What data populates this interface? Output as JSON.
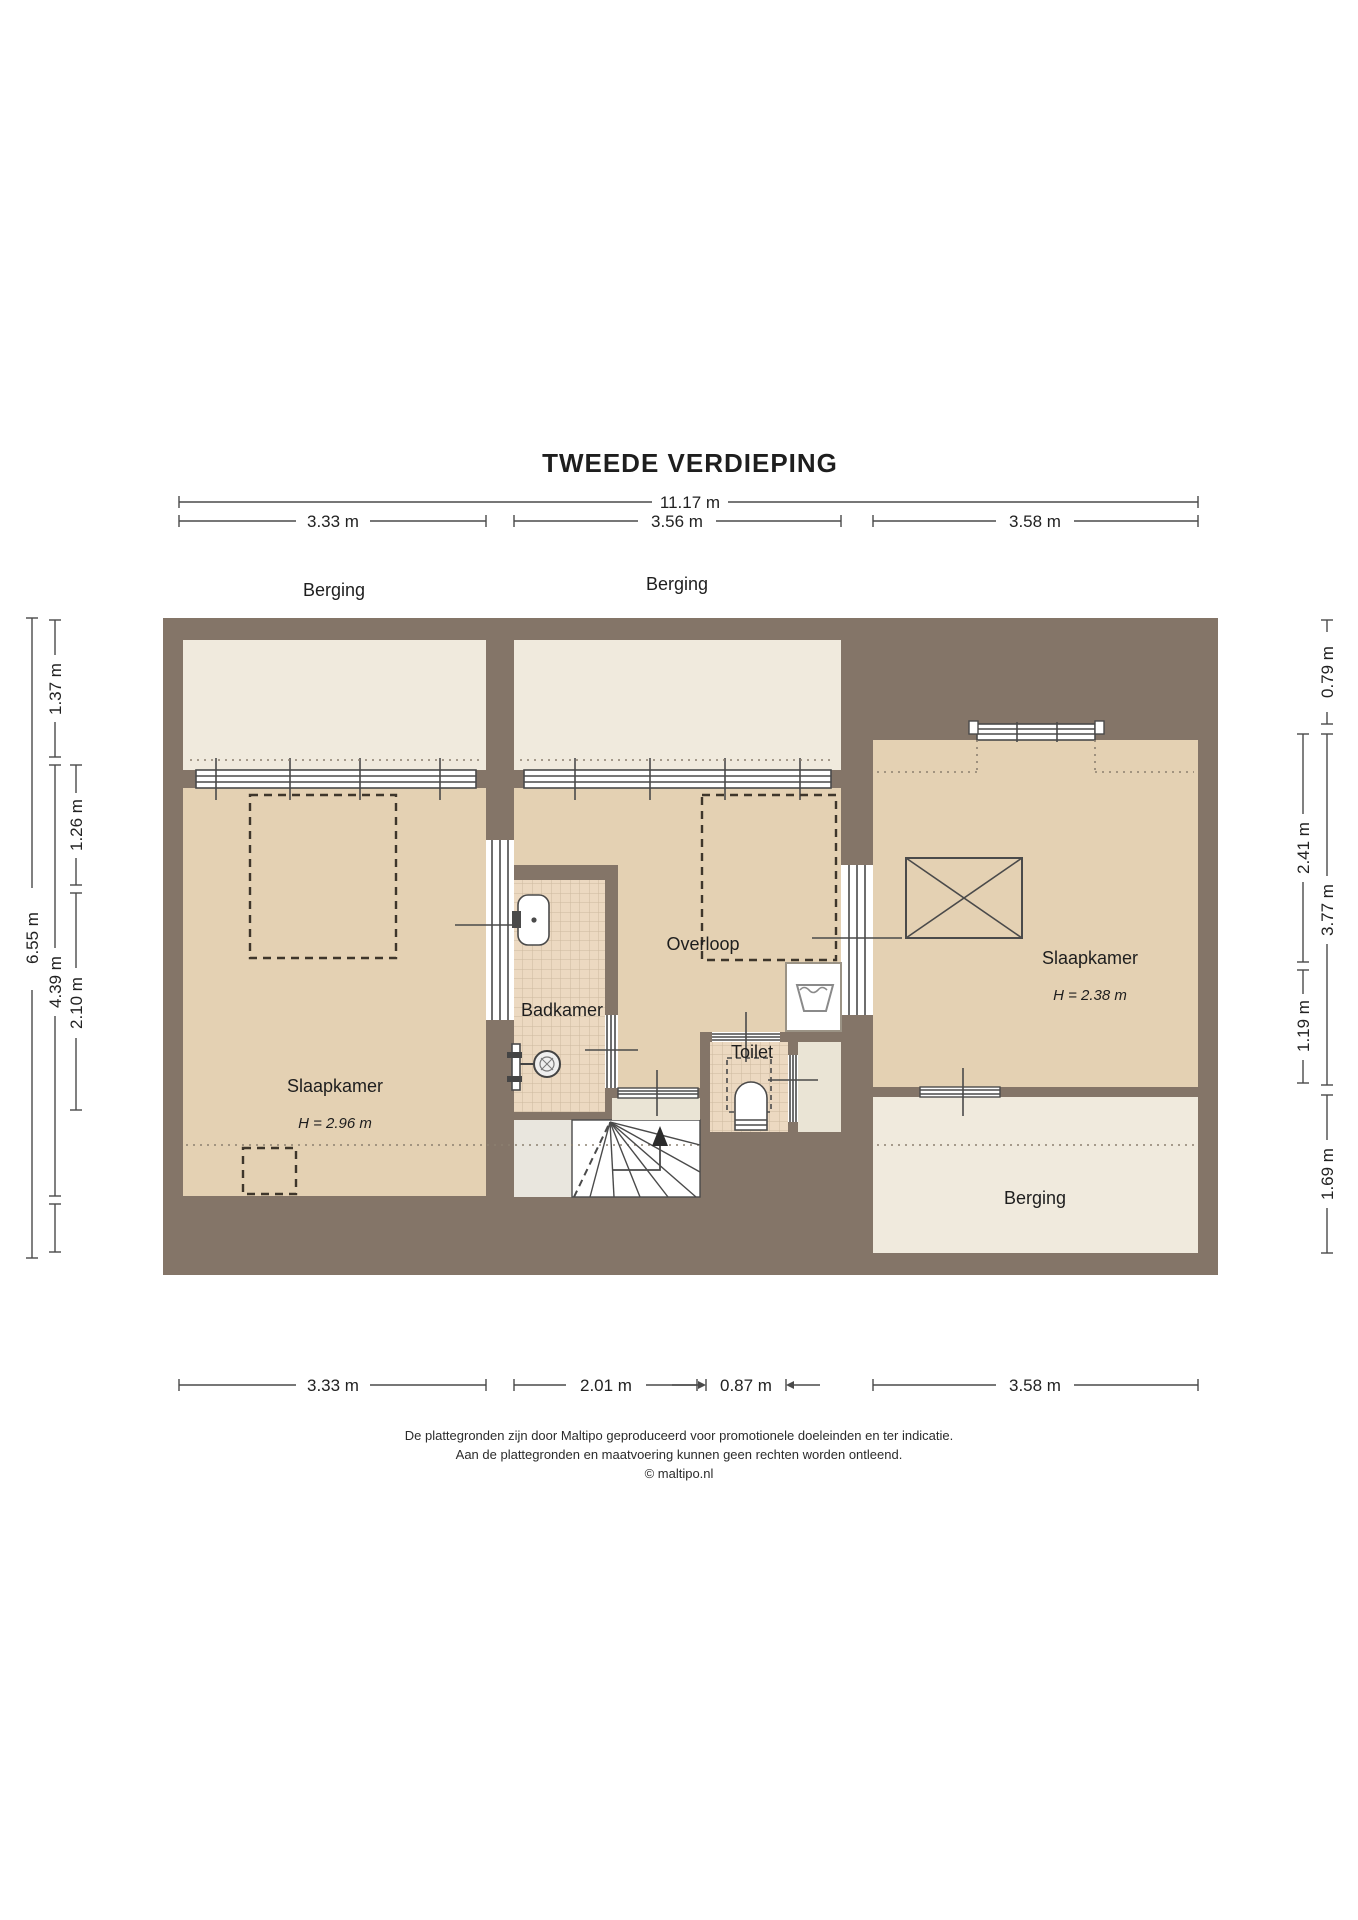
{
  "title": "TWEEDE VERDIEPING",
  "dims": {
    "total_width": "11.17 m",
    "top": [
      "3.33 m",
      "3.56 m",
      "3.58 m"
    ],
    "bottom": [
      "3.33 m",
      "2.01 m",
      "0.87 m",
      "3.58 m"
    ],
    "left_total": "6.55 m",
    "left": [
      "1.37 m",
      "1.26 m",
      "4.39 m",
      "2.10 m"
    ],
    "right": [
      "0.79 m",
      "2.41 m",
      "3.77 m",
      "1.19 m",
      "1.69 m"
    ]
  },
  "rooms": {
    "berging_left": "Berging",
    "berging_middle": "Berging",
    "berging_right": "Berging",
    "slaapkamer_left": "Slaapkamer",
    "slaapkamer_left_height": "H = 2.96 m",
    "slaapkamer_right": "Slaapkamer",
    "slaapkamer_right_height": "H = 2.38 m",
    "overloop": "Overloop",
    "badkamer": "Badkamer",
    "toilet": "Toilet"
  },
  "footer": [
    "De plattegronden zijn door Maltipo geproduceerd voor promotionele doeleinden en ter indicatie.",
    "Aan de plattegronden en maatvoering kunnen geen rechten worden ontleend.",
    "© maltipo.nl"
  ],
  "colors": {
    "wall": "#847568",
    "room": "#e4d1b3",
    "storage": "#f0eadd",
    "tile": "#ecd9c1",
    "stairs": "#ffffff",
    "line": "#4a4a4a"
  }
}
